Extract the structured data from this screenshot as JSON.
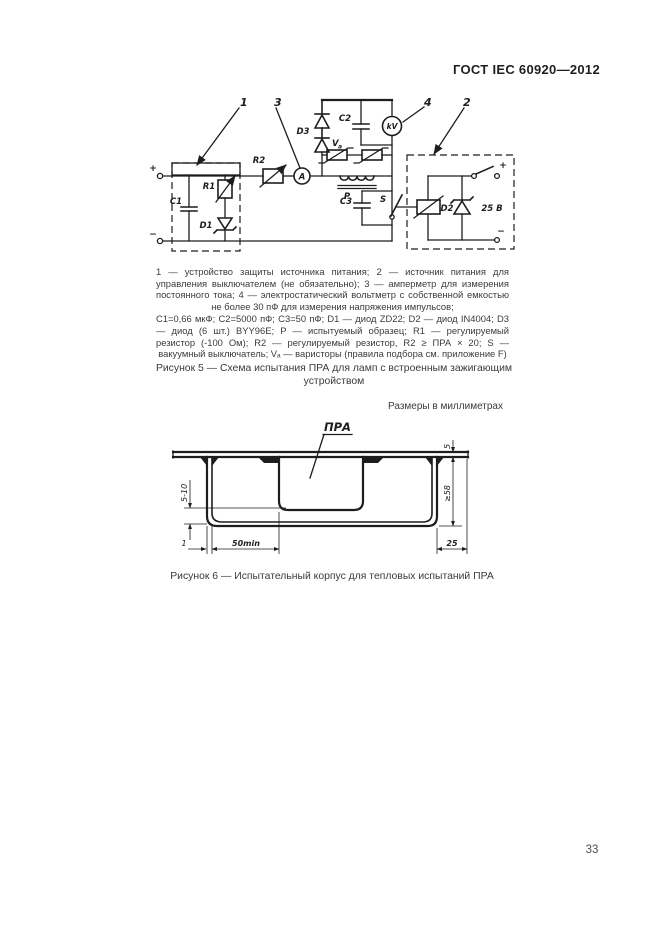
{
  "page": {
    "header": "ГОСТ IEC 60920—2012",
    "number": "33"
  },
  "figure5": {
    "callout_1": "1",
    "callout_2": "2",
    "callout_3": "3",
    "callout_4": "4",
    "labels": {
      "plus": "+",
      "minus": "−",
      "c1": "C1",
      "r1": "R1",
      "d1": "D1",
      "r2": "R2",
      "ammeter": "A",
      "d3": "D3",
      "c2": "C2",
      "kv": "kV",
      "va_main": "V",
      "va_sub": "a",
      "p": "P",
      "c3": "C3",
      "s": "S",
      "d2": "D2",
      "supply": "25 В"
    },
    "legend_line1": "1 — устройство защиты источника питания; 2 — источник питания для управления выключателем (не обязательно); 3 — амперметр для измерения постоянного тока; 4 — электростатический вольтметр с собственной емкостью не более 30 пФ для измерения напряжения импульсов;",
    "legend_line2": "C1=0,66 мкФ; C2=5000 пФ; C3=50 пФ; D1 — диод ZD22; D2 — диод IN4004; D3 — диод (6 шт.) BYY96E; P — испытуемый образец; R1 — регулируемый резистор (-100 Ом); R2 — регулируемый резистор, R2 ≥ ПРА × 20; S — вакуумный выключатель; Vₐ — варисторы (правила подбора см. приложение F)",
    "caption": "Рисунок 5 — Схема испытания ПРА для ламп с встроенным зажигающим устройством"
  },
  "figure6": {
    "units_note": "Размеры в миллиметрах",
    "part_label": "ПРА",
    "dim_plate_thickness": "5",
    "dim_depth": "≥58",
    "dim_gap": "5-10",
    "dim_wall": "1",
    "dim_span": "50min",
    "dim_edge": "25",
    "caption": "Рисунок 6 — Испытательный корпус для тепловых испытаний ПРА"
  }
}
